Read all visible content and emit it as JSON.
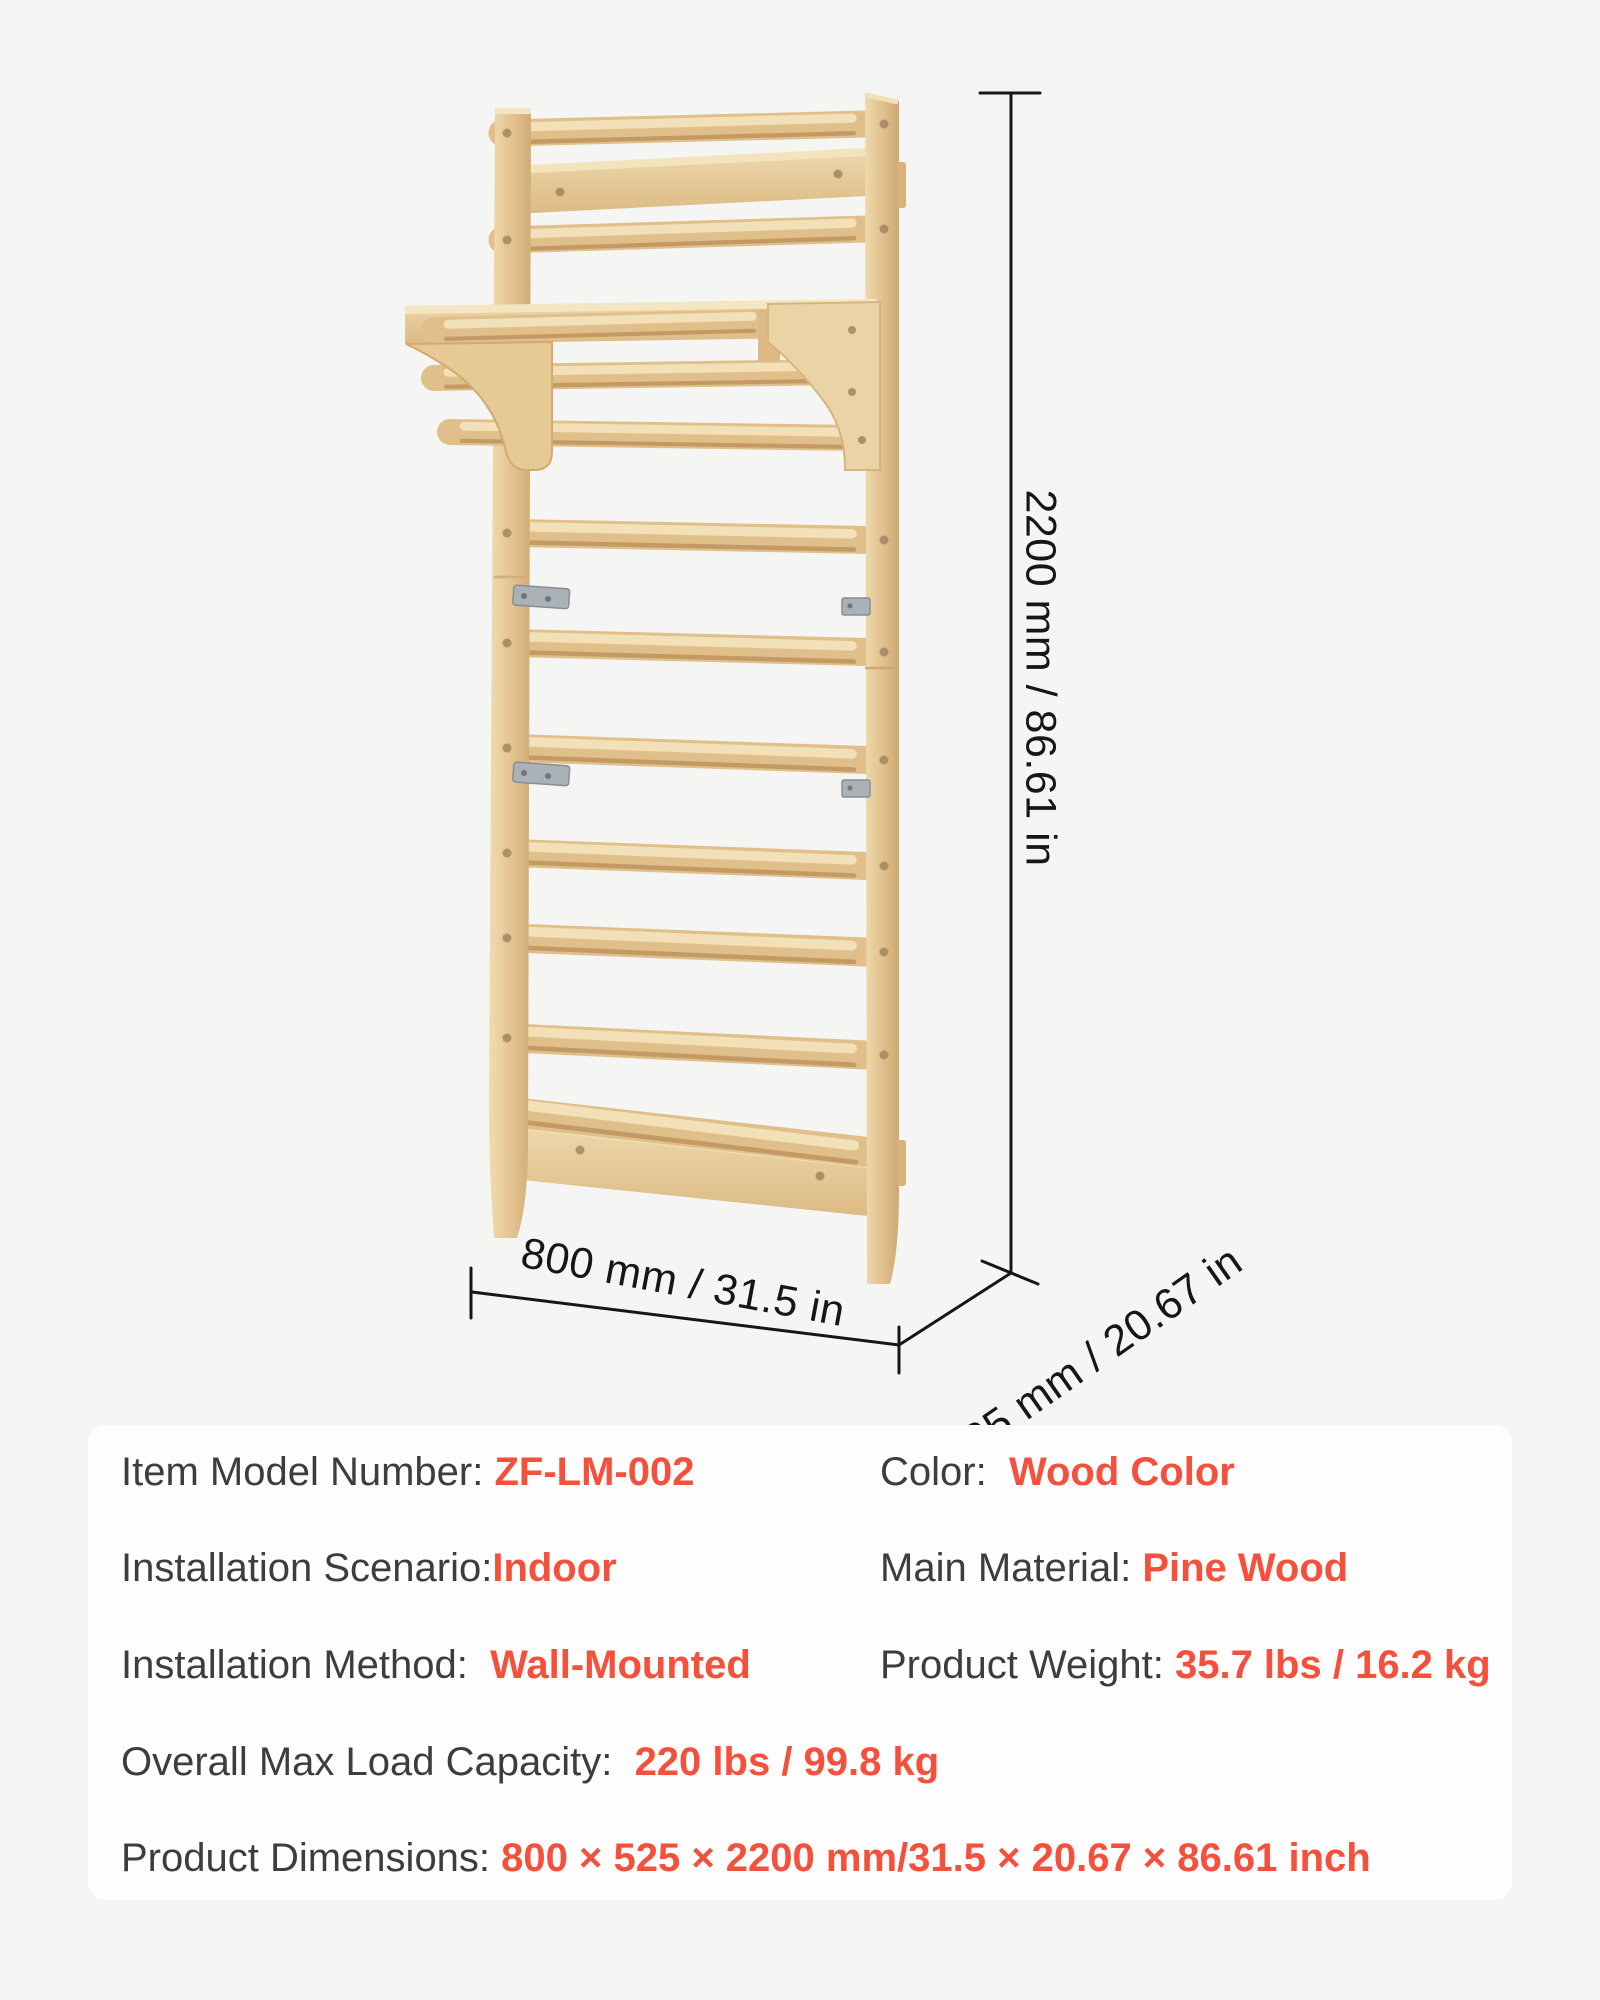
{
  "dimensions": {
    "height_label": "2200 mm / 86.61 in",
    "width_label": "800 mm / 31.5 in",
    "depth_label": "525 mm / 20.67 in"
  },
  "specs": {
    "rows": [
      {
        "cells": [
          {
            "label": "Item Model Number: ",
            "value": "ZF-LM-002"
          },
          {
            "label": "Color:  ",
            "value": "Wood Color"
          }
        ]
      },
      {
        "cells": [
          {
            "label": "Installation Scenario:",
            "value": "Indoor"
          },
          {
            "label": "Main Material: ",
            "value": "Pine Wood"
          }
        ]
      },
      {
        "cells": [
          {
            "label": "Installation Method:  ",
            "value": "Wall-Mounted"
          },
          {
            "label": "Product Weight: ",
            "value": "35.7 lbs / 16.2 kg"
          }
        ]
      },
      {
        "cells": [
          {
            "label": "Overall Max Load Capacity:  ",
            "value": "220 lbs / 99.8 kg"
          }
        ]
      },
      {
        "cells": [
          {
            "label": "Product Dimensions: ",
            "value": "800 × 525 × 2200 mm/31.5 × 20.67 × 86.61 inch"
          }
        ]
      }
    ]
  },
  "colors": {
    "accent": "#F4503C",
    "label_text": "#3D3D3D",
    "dimension_text": "#161616",
    "panel_bg": "#FDFDFD",
    "page_bg": "#F5F5F4",
    "wood_light": "#F0DCB0",
    "wood_mid": "#E4C593",
    "wood_dark": "#D2AC76",
    "metal": "#AAB1B7"
  }
}
